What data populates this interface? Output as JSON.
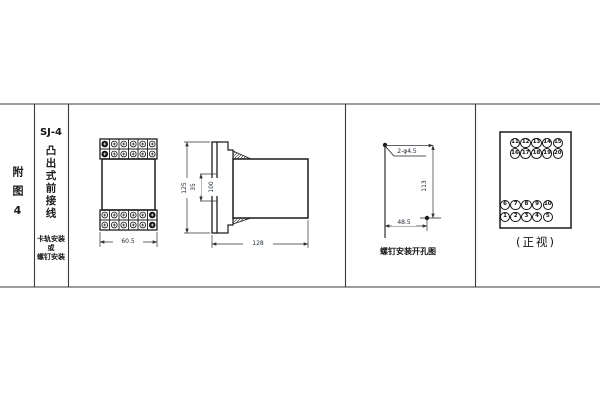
{
  "figure_column": {
    "label": "附图4"
  },
  "title_column": {
    "model": "SJ-4",
    "name": "凸出式前接线",
    "note_lines": [
      "卡轨安装",
      "或",
      "螺钉安装"
    ]
  },
  "front_view": {
    "width_dim": "60.5"
  },
  "side_view": {
    "height_dim": "125",
    "rail_dim": "35",
    "inner_dim": "100",
    "depth_dim": "128"
  },
  "drill_view": {
    "holes_label": "2-φ4.5",
    "height_dim": "113",
    "width_dim": "48.5",
    "caption": "螺钉安装开孔图"
  },
  "terminal_view": {
    "caption": "(正视)",
    "top_rows": [
      [
        "11",
        "12",
        "13",
        "14",
        "15"
      ],
      [
        "16",
        "17",
        "18",
        "19",
        "20"
      ]
    ],
    "bottom_rows": [
      [
        "6",
        "7",
        "8",
        "9",
        "10"
      ],
      [
        "1",
        "2",
        "3",
        "4",
        "5"
      ]
    ]
  },
  "colors": {
    "line": "#1c1c1c",
    "dim_text": "#1d2733",
    "background": "#ffffff"
  }
}
